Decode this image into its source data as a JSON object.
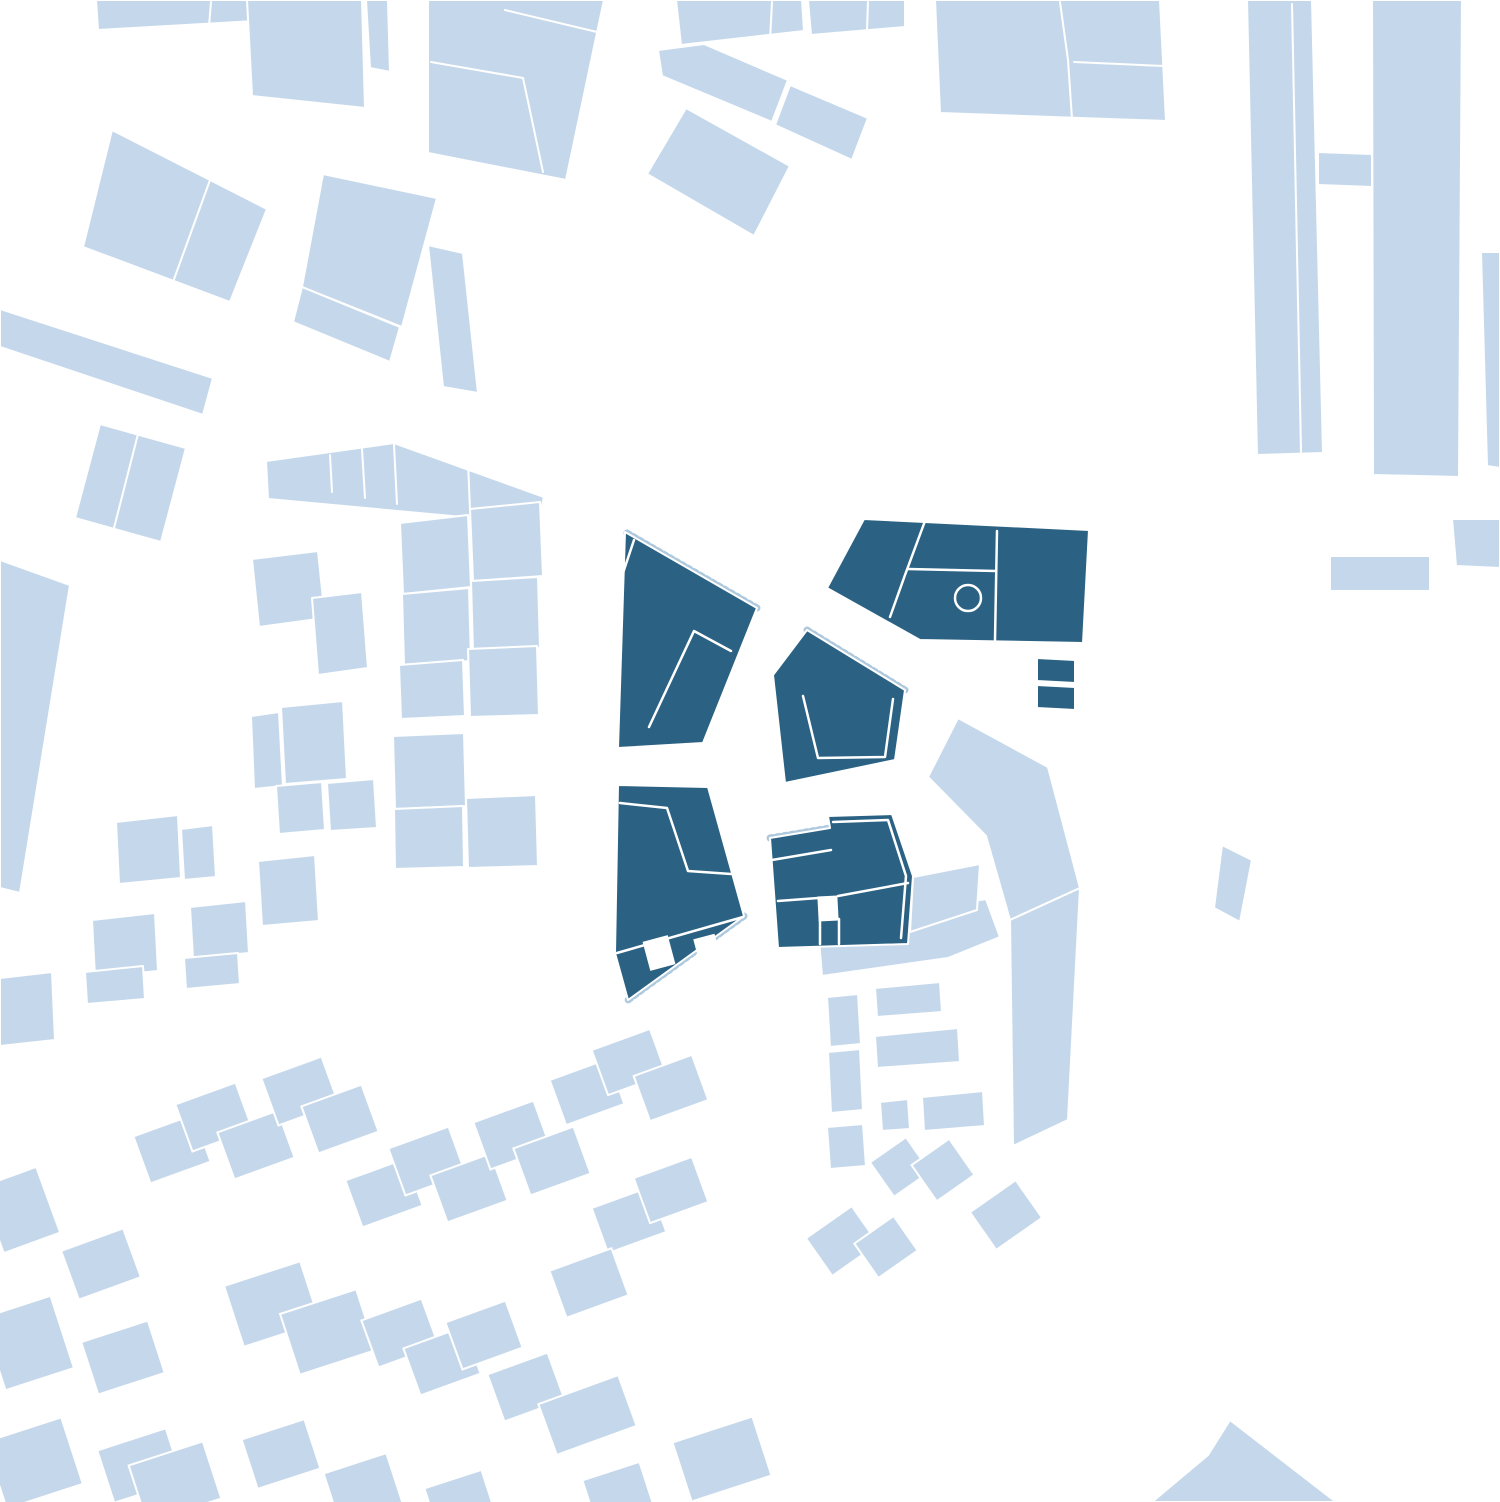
{
  "canvas": {
    "width": 1500,
    "height": 1502,
    "background": "#ffffff"
  },
  "colors": {
    "context_building": "#c5d8eb",
    "site_building": "#2b6283",
    "street": "#ffffff",
    "outline": "#ffffff",
    "hatch": "#aec9dd"
  },
  "map": {
    "layers": [
      {
        "name": "context-buildings",
        "type": "polygon",
        "fill": "@context_building",
        "stroke": "@outline",
        "stroke_width": 2,
        "items": [
          {
            "id": "top-strip",
            "points": "96,0 258,0 255,21 98,30"
          },
          {
            "id": "top-big",
            "points": "247,0 362,0 365,108 252,96"
          },
          {
            "id": "top-sliver",
            "points": "366,0 388,0 390,72 370,68"
          },
          {
            "id": "block-nw-large",
            "points": "428,0 604,0 597,33 566,180 428,153"
          },
          {
            "id": "top-strip-2",
            "points": "676,0 802,0 804,31 681,45"
          },
          {
            "id": "top-strip-3",
            "points": "808,0 905,0 905,27 811,35"
          },
          {
            "id": "band-1",
            "points": "658,50 704,44 788,80 772,122 662,76"
          },
          {
            "id": "band-2",
            "points": "790,85 868,118 852,160 775,125"
          },
          {
            "id": "block-n-quad",
            "points": "686,108 790,166 754,236 647,174"
          },
          {
            "id": "block-ne-large",
            "points": "935,0 1160,0 1166,121 940,113"
          },
          {
            "id": "slab-1",
            "points": "1247,0 1312,0 1323,453 1257,455"
          },
          {
            "id": "slab-2",
            "points": "1372,0 1462,0 1459,477 1373,475"
          },
          {
            "id": "slab-2-tab",
            "points": "1318,152 1372,154 1372,187 1318,185"
          },
          {
            "id": "small-east-1",
            "points": "1330,556 1430,556 1430,591 1330,591"
          },
          {
            "id": "edge-sliver-east",
            "points": "1481,252 1500,252 1500,468 1487,466"
          },
          {
            "id": "small-east-2",
            "points": "1452,519 1500,519 1500,568 1456,566"
          },
          {
            "id": "block-west-pair",
            "points": "112,130 267,209 230,302 83,247"
          },
          {
            "id": "block-west-square",
            "points": "323,174 437,198 402,327 302,287"
          },
          {
            "id": "block-west-square-ext",
            "points": "302,287 400,327 390,362 293,322"
          },
          {
            "id": "block-west-tall",
            "points": "428,245 463,253 478,393 443,387"
          },
          {
            "id": "bar-west",
            "points": "0,309 213,378 203,415 0,347"
          },
          {
            "id": "block-west-2",
            "points": "100,424 186,448 161,542 75,518"
          },
          {
            "id": "edge-wedge-west",
            "points": "0,560 70,585 20,893 0,888"
          },
          {
            "id": "band-center",
            "points": "266,461 394,443 544,497 538,524 268,499"
          },
          {
            "id": "parcel-sq-1",
            "points": "400,523 468,515 471,587 403,594"
          },
          {
            "id": "parcel-sq-2",
            "points": "470,509 540,502 543,576 473,581"
          },
          {
            "id": "parcel-sq-3",
            "points": "402,594 469,588 471,661 404,665"
          },
          {
            "id": "parcel-sq-4",
            "points": "471,581 538,577 540,648 473,652"
          },
          {
            "id": "parcel-sq-5",
            "points": "399,665 463,660 465,716 401,719"
          },
          {
            "id": "parcel-sq-6",
            "points": "468,649 537,646 539,715 470,717"
          },
          {
            "id": "parcel-sq-7",
            "points": "393,736 464,733 466,806 395,809"
          },
          {
            "id": "parcel-sq-8",
            "points": "394,809 463,806 464,867 395,869"
          },
          {
            "id": "parcel-sq-9",
            "points": "466,798 536,795 538,866 468,868"
          },
          {
            "id": "house-p1",
            "points": "252,559 318,551 325,618 259,627"
          },
          {
            "id": "house-p2",
            "points": "312,598 362,592 368,668 318,675"
          },
          {
            "id": "house-p3",
            "points": "251,716 279,712 283,786 254,789"
          },
          {
            "id": "house-p4",
            "points": "281,707 343,701 347,779 285,784"
          },
          {
            "id": "house-pa",
            "points": "276,786 322,782 325,830 279,834"
          },
          {
            "id": "house-pb",
            "points": "327,783 374,779 377,828 330,831"
          },
          {
            "id": "house-pc",
            "points": "258,861 315,855 319,921 262,926"
          },
          {
            "id": "house-w1",
            "points": "116,822 178,815 181,878 119,884"
          },
          {
            "id": "house-w2",
            "points": "181,829 213,825 216,877 184,880"
          },
          {
            "id": "house-w3",
            "points": "92,920 155,913 158,971 95,977"
          },
          {
            "id": "house-w4",
            "points": "190,907 246,901 249,953 193,958"
          },
          {
            "id": "house-w5",
            "points": "85,972 143,966 145,999 87,1004"
          },
          {
            "id": "house-w6",
            "points": "184,958 238,953 240,984 186,989"
          },
          {
            "id": "edge-square-west",
            "points": "0,978 52,972 55,1040 0,1046"
          },
          {
            "id": "l-building-bar",
            "points": "818,928 855,921 855,908 879,906 879,917 986,899 1000,937 948,958 822,976"
          },
          {
            "id": "chevron-building",
            "points": "928,777 958,718 1048,767 1080,888 1010,920 986,836"
          },
          {
            "id": "chevron-arm",
            "points": "1010,920 1080,888 1068,1120 1013,1146"
          },
          {
            "id": "attach-piece",
            "points": "913,877 980,864 977,910 910,932"
          },
          {
            "id": "col-rect-1",
            "points": "827,997 858,994 861,1044 830,1047"
          },
          {
            "id": "col-rect-2",
            "points": "828,1052 860,1049 863,1110 831,1113"
          },
          {
            "id": "row-rect-1",
            "points": "875,988 940,982 942,1012 877,1017"
          },
          {
            "id": "row-rect-2",
            "points": "875,1036 958,1028 960,1062 877,1068"
          },
          {
            "id": "small-rect-1",
            "points": "880,1102 908,1099 910,1129 882,1131"
          },
          {
            "id": "row-rect-3",
            "points": "922,1097 983,1091 985,1126 924,1131"
          },
          {
            "id": "small-rect-2",
            "points": "827,1127 863,1124 866,1166 830,1169"
          },
          {
            "id": "lone-piece-east",
            "points": "1222,845 1252,860 1240,922 1214,908"
          },
          {
            "id": "bottom-chevron",
            "points": "1230,1420 1336,1502 1152,1502 1208,1455"
          }
        ]
      },
      {
        "name": "context-houses",
        "type": "rect",
        "fill": "@context_building",
        "stroke": "@outline",
        "stroke_width": 2,
        "items": [
          {
            "x": 140,
            "y": 1124,
            "w": 64,
            "h": 50,
            "r": -20
          },
          {
            "x": 182,
            "y": 1092,
            "w": 64,
            "h": 50,
            "r": -20
          },
          {
            "x": 224,
            "y": 1120,
            "w": 64,
            "h": 50,
            "r": -20
          },
          {
            "x": 268,
            "y": 1066,
            "w": 64,
            "h": 50,
            "r": -20
          },
          {
            "x": 308,
            "y": 1094,
            "w": 64,
            "h": 50,
            "r": -20
          },
          {
            "x": -10,
            "y": 1175,
            "w": 60,
            "h": 70,
            "r": -20
          },
          {
            "x": 68,
            "y": 1238,
            "w": 66,
            "h": 52,
            "r": -20
          },
          {
            "x": -8,
            "y": 1305,
            "w": 72,
            "h": 76,
            "r": -18
          },
          {
            "x": 88,
            "y": 1330,
            "w": 70,
            "h": 55,
            "r": -18
          },
          {
            "x": -6,
            "y": 1428,
            "w": 80,
            "h": 70,
            "r": -18
          },
          {
            "x": 104,
            "y": 1438,
            "w": 72,
            "h": 55,
            "r": -18
          },
          {
            "x": 352,
            "y": 1168,
            "w": 64,
            "h": 50,
            "r": -20
          },
          {
            "x": 395,
            "y": 1136,
            "w": 64,
            "h": 50,
            "r": -20
          },
          {
            "x": 437,
            "y": 1163,
            "w": 64,
            "h": 50,
            "r": -20
          },
          {
            "x": 480,
            "y": 1110,
            "w": 64,
            "h": 50,
            "r": -20
          },
          {
            "x": 520,
            "y": 1136,
            "w": 64,
            "h": 50,
            "r": -20
          },
          {
            "x": 556,
            "y": 1068,
            "w": 62,
            "h": 48,
            "r": -20
          },
          {
            "x": 598,
            "y": 1038,
            "w": 62,
            "h": 48,
            "r": -20
          },
          {
            "x": 640,
            "y": 1064,
            "w": 62,
            "h": 48,
            "r": -20
          },
          {
            "x": 598,
            "y": 1196,
            "w": 62,
            "h": 48,
            "r": -20
          },
          {
            "x": 640,
            "y": 1166,
            "w": 62,
            "h": 48,
            "r": -20
          },
          {
            "x": 232,
            "y": 1272,
            "w": 80,
            "h": 64,
            "r": -18
          },
          {
            "x": 288,
            "y": 1300,
            "w": 80,
            "h": 64,
            "r": -18
          },
          {
            "x": 368,
            "y": 1308,
            "w": 64,
            "h": 50,
            "r": -20
          },
          {
            "x": 410,
            "y": 1336,
            "w": 64,
            "h": 50,
            "r": -20
          },
          {
            "x": 452,
            "y": 1310,
            "w": 64,
            "h": 50,
            "r": -20
          },
          {
            "x": 494,
            "y": 1362,
            "w": 64,
            "h": 50,
            "r": -20
          },
          {
            "x": 545,
            "y": 1388,
            "w": 85,
            "h": 54,
            "r": -20
          },
          {
            "x": 556,
            "y": 1258,
            "w": 66,
            "h": 50,
            "r": -20
          },
          {
            "x": 136,
            "y": 1452,
            "w": 78,
            "h": 60,
            "r": -18
          },
          {
            "x": 248,
            "y": 1428,
            "w": 66,
            "h": 52,
            "r": -18
          },
          {
            "x": 330,
            "y": 1462,
            "w": 66,
            "h": 52,
            "r": -18
          },
          {
            "x": 430,
            "y": 1478,
            "w": 60,
            "h": 46,
            "r": -18
          },
          {
            "x": 588,
            "y": 1470,
            "w": 60,
            "h": 46,
            "r": -18
          },
          {
            "x": 680,
            "y": 1428,
            "w": 84,
            "h": 62,
            "r": -18
          },
          {
            "x": 878,
            "y": 1146,
            "w": 44,
            "h": 42,
            "r": -35
          },
          {
            "x": 920,
            "y": 1148,
            "w": 46,
            "h": 44,
            "r": -35
          },
          {
            "x": 978,
            "y": 1192,
            "w": 56,
            "h": 46,
            "r": -35
          },
          {
            "x": 814,
            "y": 1218,
            "w": 56,
            "h": 46,
            "r": -35
          },
          {
            "x": 862,
            "y": 1226,
            "w": 48,
            "h": 42,
            "r": -35
          }
        ]
      },
      {
        "name": "site-edge-hatch",
        "type": "line",
        "stroke": "@hatch",
        "stroke_width": 7,
        "dash": "3 4",
        "items": [
          {
            "points": "627,533 757,608"
          },
          {
            "points": "807,630 905,690"
          },
          {
            "points": "744,916 628,1000"
          },
          {
            "points": "770,838 830,828"
          }
        ]
      },
      {
        "name": "site-buildings",
        "type": "polygon",
        "fill": "@site_building",
        "stroke": "@outline",
        "stroke_width": 2,
        "items": [
          {
            "id": "site-block-a",
            "points": "625,532 757,608 703,743 618,748"
          },
          {
            "id": "site-block-b",
            "points": "773,675 807,630 905,690 895,760 785,783"
          },
          {
            "id": "site-block-e",
            "points": "827,588 864,519 1089,530 1083,643 920,640"
          },
          {
            "id": "site-small-1",
            "points": "1037,658 1075,660 1075,683 1037,681"
          },
          {
            "id": "site-small-2",
            "points": "1037,685 1075,687 1075,710 1037,708"
          },
          {
            "id": "site-block-c",
            "points": "618,785 708,787 744,916 628,1000 615,953"
          },
          {
            "id": "site-block-d",
            "points": "770,838 830,828 828,816 892,814 913,876 908,944 778,948"
          }
        ]
      },
      {
        "name": "site-notches",
        "type": "rect",
        "fill": "@street",
        "stroke": "none",
        "stroke_width": 0,
        "items": [
          {
            "x": 646,
            "y": 938,
            "w": 26,
            "h": 30,
            "r": -15
          },
          {
            "x": 697,
            "y": 936,
            "w": 22,
            "h": 32,
            "r": -15
          },
          {
            "x": 818,
            "y": 896,
            "w": 20,
            "h": 25,
            "r": -3
          }
        ]
      },
      {
        "name": "site-detail-lines",
        "type": "line",
        "stroke": "@street",
        "stroke_width": 2.5,
        "dash": "",
        "items": [
          {
            "points": "731,651 694,631 649,727"
          },
          {
            "points": "634,540 621,579"
          },
          {
            "points": "803,696 818,758 885,757 893,699"
          },
          {
            "points": "925,521 905,575 890,617"
          },
          {
            "points": "908,569 996,571"
          },
          {
            "points": "997,531 995,640"
          },
          {
            "points": "620,803 667,808 688,871 731,874"
          },
          {
            "points": "743,917 617,953"
          },
          {
            "points": "772,860 831,850"
          },
          {
            "points": "778,901 818,898"
          },
          {
            "points": "838,896 908,883"
          },
          {
            "points": "833,822 888,820 906,876 901,938"
          },
          {
            "points": "820,920 820,944"
          },
          {
            "points": "839,919 839,944"
          }
        ]
      },
      {
        "name": "context-divider-lines",
        "type": "line",
        "stroke": "@street",
        "stroke_width": 2,
        "dash": "",
        "items": [
          {
            "points": "211,2 209,26"
          },
          {
            "points": "505,10 597,32"
          },
          {
            "points": "431,62 523,78 543,172"
          },
          {
            "points": "772,2 770,40"
          },
          {
            "points": "868,2 867,30"
          },
          {
            "points": "1060,2 1068,60 1072,119"
          },
          {
            "points": "1074,62 1164,66"
          },
          {
            "points": "1292,4 1301,452"
          },
          {
            "points": "210,180 173,282"
          },
          {
            "points": "138,434 114,528"
          },
          {
            "points": "330,455 332,492"
          },
          {
            "points": "362,449 365,498"
          },
          {
            "points": "394,445 397,504"
          },
          {
            "points": "468,461 470,510"
          }
        ]
      },
      {
        "name": "site-circle-marks",
        "type": "circle",
        "stroke": "@street",
        "stroke_width": 2.5,
        "dash": "",
        "items": [
          {
            "cx": 968,
            "cy": 598,
            "r": 13
          }
        ]
      }
    ]
  }
}
